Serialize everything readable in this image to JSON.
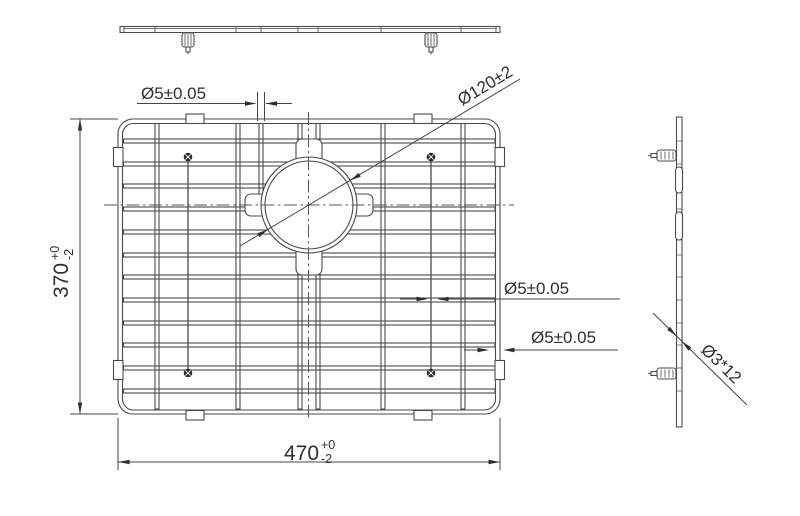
{
  "title": "sink-grid-technical-drawing",
  "colors": {
    "background": "#ffffff",
    "line": "#4a4a4a",
    "dim_line": "#454545",
    "arrow": "#2e2e2e",
    "text": "#2f2f2f",
    "screw": "#2b2b2b"
  },
  "views": {
    "front": {
      "name": "front edge view"
    },
    "plan": {
      "name": "plan view of grid"
    },
    "side": {
      "name": "side edge view"
    }
  },
  "dimensions": {
    "wire_top": {
      "label": "Ø5±0.05"
    },
    "drain_circle": {
      "label": "Ø120±2"
    },
    "wire_mid": {
      "label": "Ø5±0.05"
    },
    "wire_frame": {
      "label": "Ø5±0.05"
    },
    "width": {
      "value": "470",
      "tol_plus": "+0",
      "tol_minus": "-2"
    },
    "height": {
      "value": "370",
      "tol_plus": "+0",
      "tol_minus": "-2"
    },
    "foot_screw": {
      "label": "Ø3*12"
    }
  }
}
